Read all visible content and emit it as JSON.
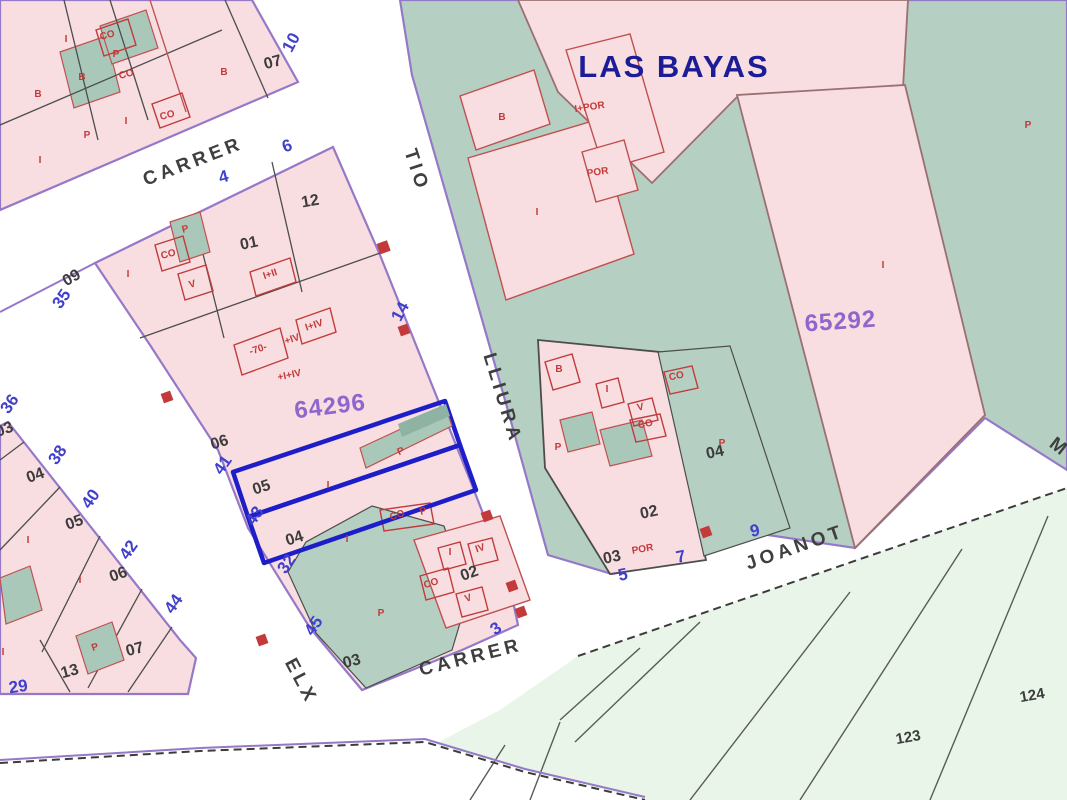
{
  "map": {
    "title": "LAS BAYAS",
    "colors": {
      "urban_parcel_pink": "#f8dde1",
      "urban_green": "#b6cfc3",
      "rural_green": "#e9f5e9",
      "block_outline_purple": "#9678c8",
      "highlight_blue": "#1e1ec8",
      "parcel_id_purple": "#9066cc",
      "street_number_blue": "#4040cc",
      "building_label_red": "#c23a3a",
      "title_navy": "#1c1c96"
    },
    "parcel_ids": [
      {
        "text": "64296",
        "x": 331,
        "y": 414,
        "rot": -7
      },
      {
        "text": "65292",
        "x": 841,
        "y": 329,
        "rot": -4
      }
    ],
    "streets": [
      {
        "text": "CARRER",
        "x": 195,
        "y": 167,
        "rot": -21
      },
      {
        "text": "TIO",
        "x": 411,
        "y": 172,
        "rot": 72
      },
      {
        "text": "LLIURA",
        "x": 497,
        "y": 400,
        "rot": 73
      },
      {
        "text": "CARRER",
        "x": 472,
        "y": 663,
        "rot": -14
      },
      {
        "text": "ELX",
        "x": 296,
        "y": 684,
        "rot": 62
      },
      {
        "text": "JOANOT",
        "x": 797,
        "y": 553,
        "rot": -19
      },
      {
        "text": "M",
        "x": 1056,
        "y": 452,
        "rot": 38
      }
    ],
    "numbers_black": [
      {
        "text": "07",
        "x": 274,
        "y": 67,
        "rot": -15
      },
      {
        "text": "12",
        "x": 311,
        "y": 206,
        "rot": -10
      },
      {
        "text": "01",
        "x": 250,
        "y": 248,
        "rot": -12
      },
      {
        "text": "09",
        "x": 74,
        "y": 282,
        "rot": -30
      },
      {
        "text": "06",
        "x": 221,
        "y": 447,
        "rot": -18
      },
      {
        "text": "05",
        "x": 263,
        "y": 492,
        "rot": -18
      },
      {
        "text": "04",
        "x": 296,
        "y": 543,
        "rot": -18
      },
      {
        "text": "03",
        "x": 353,
        "y": 666,
        "rot": -15
      },
      {
        "text": "02",
        "x": 471,
        "y": 578,
        "rot": -20
      },
      {
        "text": "02",
        "x": 650,
        "y": 517,
        "rot": -12
      },
      {
        "text": "03",
        "x": 613,
        "y": 562,
        "rot": -12
      },
      {
        "text": "04",
        "x": 716,
        "y": 457,
        "rot": -12
      },
      {
        "text": "03",
        "x": 6,
        "y": 434,
        "rot": -20
      },
      {
        "text": "04",
        "x": 37,
        "y": 480,
        "rot": -20
      },
      {
        "text": "05",
        "x": 76,
        "y": 527,
        "rot": -20
      },
      {
        "text": "06",
        "x": 120,
        "y": 579,
        "rot": -20
      },
      {
        "text": "07",
        "x": 136,
        "y": 654,
        "rot": -15
      },
      {
        "text": "13",
        "x": 71,
        "y": 676,
        "rot": -15
      }
    ],
    "numbers_blue": [
      {
        "text": "10",
        "x": 296,
        "y": 45,
        "rot": -62
      },
      {
        "text": "6",
        "x": 289,
        "y": 151,
        "rot": -20
      },
      {
        "text": "4",
        "x": 225,
        "y": 182,
        "rot": -15
      },
      {
        "text": "35",
        "x": 66,
        "y": 302,
        "rot": -55
      },
      {
        "text": "14",
        "x": 405,
        "y": 314,
        "rot": -62
      },
      {
        "text": "41",
        "x": 227,
        "y": 468,
        "rot": -55
      },
      {
        "text": "43",
        "x": 259,
        "y": 519,
        "rot": -55
      },
      {
        "text": "32",
        "x": 291,
        "y": 567,
        "rot": -55
      },
      {
        "text": "45",
        "x": 318,
        "y": 629,
        "rot": -55
      },
      {
        "text": "36",
        "x": 14,
        "y": 407,
        "rot": -55
      },
      {
        "text": "38",
        "x": 62,
        "y": 458,
        "rot": -55
      },
      {
        "text": "40",
        "x": 95,
        "y": 502,
        "rot": -55
      },
      {
        "text": "42",
        "x": 133,
        "y": 553,
        "rot": -55
      },
      {
        "text": "44",
        "x": 178,
        "y": 607,
        "rot": -55
      },
      {
        "text": "29",
        "x": 19,
        "y": 692,
        "rot": -8
      },
      {
        "text": "5",
        "x": 624,
        "y": 580,
        "rot": -12
      },
      {
        "text": "7",
        "x": 682,
        "y": 562,
        "rot": -12
      },
      {
        "text": "9",
        "x": 756,
        "y": 536,
        "rot": -12
      },
      {
        "text": "3",
        "x": 499,
        "y": 633,
        "rot": -35
      }
    ],
    "labels_red": [
      {
        "text": "I",
        "x": 66,
        "y": 42,
        "rot": 0
      },
      {
        "text": "CO",
        "x": 108,
        "y": 38,
        "rot": -15
      },
      {
        "text": "P",
        "x": 116,
        "y": 57,
        "rot": 0
      },
      {
        "text": "B",
        "x": 82,
        "y": 80,
        "rot": 0
      },
      {
        "text": "CO",
        "x": 127,
        "y": 77,
        "rot": -15
      },
      {
        "text": "B",
        "x": 38,
        "y": 97,
        "rot": 0
      },
      {
        "text": "B",
        "x": 224,
        "y": 75,
        "rot": 0
      },
      {
        "text": "CO",
        "x": 168,
        "y": 118,
        "rot": -15
      },
      {
        "text": "I",
        "x": 126,
        "y": 124,
        "rot": 0
      },
      {
        "text": "I",
        "x": 40,
        "y": 163,
        "rot": 0
      },
      {
        "text": "P",
        "x": 87,
        "y": 138,
        "rot": 0
      },
      {
        "text": "P",
        "x": 186,
        "y": 232,
        "rot": -15
      },
      {
        "text": "CO",
        "x": 169,
        "y": 257,
        "rot": -15
      },
      {
        "text": "V",
        "x": 193,
        "y": 287,
        "rot": -15
      },
      {
        "text": "I",
        "x": 128,
        "y": 277,
        "rot": 0
      },
      {
        "text": "I+II",
        "x": 271,
        "y": 277,
        "rot": -18
      },
      {
        "text": "-70-",
        "x": 259,
        "y": 352,
        "rot": -18
      },
      {
        "text": "+IV",
        "x": 293,
        "y": 342,
        "rot": -18
      },
      {
        "text": "I+IV",
        "x": 315,
        "y": 328,
        "rot": -18
      },
      {
        "text": "+I+IV",
        "x": 290,
        "y": 378,
        "rot": -12
      },
      {
        "text": "I",
        "x": 328,
        "y": 488,
        "rot": 0
      },
      {
        "text": "I",
        "x": 347,
        "y": 542,
        "rot": 0
      },
      {
        "text": "P",
        "x": 402,
        "y": 454,
        "rot": -25
      },
      {
        "text": "CO",
        "x": 398,
        "y": 518,
        "rot": -18
      },
      {
        "text": "P",
        "x": 424,
        "y": 514,
        "rot": -18
      },
      {
        "text": "P",
        "x": 381,
        "y": 616,
        "rot": 0
      },
      {
        "text": "CO",
        "x": 432,
        "y": 586,
        "rot": -18
      },
      {
        "text": "I",
        "x": 450,
        "y": 555,
        "rot": 0
      },
      {
        "text": "IV",
        "x": 481,
        "y": 551,
        "rot": -18
      },
      {
        "text": "V",
        "x": 469,
        "y": 601,
        "rot": -18
      },
      {
        "text": "B",
        "x": 502,
        "y": 120,
        "rot": 0
      },
      {
        "text": "I+POR",
        "x": 590,
        "y": 110,
        "rot": -8
      },
      {
        "text": "POR",
        "x": 598,
        "y": 175,
        "rot": -8
      },
      {
        "text": "I",
        "x": 537,
        "y": 215,
        "rot": 0
      },
      {
        "text": "P",
        "x": 1028,
        "y": 128,
        "rot": 0
      },
      {
        "text": "B",
        "x": 559,
        "y": 372,
        "rot": 0
      },
      {
        "text": "I",
        "x": 607,
        "y": 392,
        "rot": 0
      },
      {
        "text": "V",
        "x": 641,
        "y": 410,
        "rot": -12
      },
      {
        "text": "CO",
        "x": 646,
        "y": 427,
        "rot": -12
      },
      {
        "text": "CO",
        "x": 677,
        "y": 379,
        "rot": -12
      },
      {
        "text": "P",
        "x": 558,
        "y": 450,
        "rot": 0
      },
      {
        "text": "P",
        "x": 722,
        "y": 446,
        "rot": 0
      },
      {
        "text": "POR",
        "x": 643,
        "y": 552,
        "rot": -10
      },
      {
        "text": "I",
        "x": 883,
        "y": 268,
        "rot": 0
      },
      {
        "text": "I",
        "x": 28,
        "y": 543,
        "rot": 0
      },
      {
        "text": "I",
        "x": 80,
        "y": 583,
        "rot": 0
      },
      {
        "text": "I",
        "x": 3,
        "y": 655,
        "rot": 0
      },
      {
        "text": "P",
        "x": 96,
        "y": 650,
        "rot": -20
      }
    ],
    "rural_numbers": [
      {
        "text": "123",
        "x": 909,
        "y": 742,
        "rot": -10
      },
      {
        "text": "124",
        "x": 1033,
        "y": 700,
        "rot": -10
      }
    ]
  }
}
